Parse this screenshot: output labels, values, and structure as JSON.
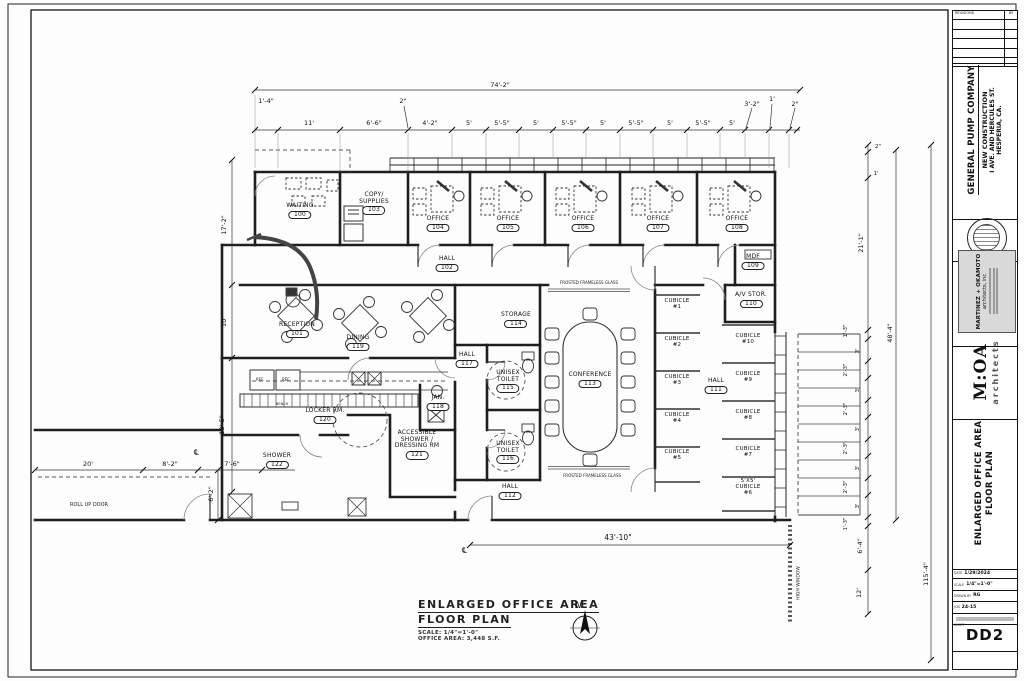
{
  "tb": {
    "client": "GENERAL PUMP COMPANY",
    "proj1": "NEW CONSTRUCTION",
    "proj2": "I AVE. AND HERCULES ST.",
    "proj3": "HESPERIA, CA.",
    "rev": "REVISIONS",
    "by": "BY",
    "firm1": "MARTINEZ + OKAMOTO",
    "firm2": "architects, inc",
    "logo": "M:OA",
    "logo_sub": "architects",
    "st1": "ENLARGED OFFICE AREA",
    "st2": "FLOOR PLAN",
    "f_date_l": "DATE",
    "f_date": "1/29/2024",
    "f_scale_l": "SCALE",
    "f_scale": "1/4\"=1'-0\"",
    "f_drawn_l": "DRAWN BY",
    "f_drawn": "RG",
    "f_job_l": "JOB",
    "f_job": "24-15",
    "sheet_l": "SHEET",
    "sheet": "DD2"
  },
  "pt": {
    "t1": "ENLARGED OFFICE AREA",
    "t2": "FLOOR PLAN",
    "scale": "SCALE: 1/4\"=1'-0\"",
    "area": "OFFICE AREA: 3,448 S.F.",
    "north": "N"
  },
  "rooms": [
    {
      "n": "WAITING",
      "id": "100"
    },
    {
      "n": "RECEPTION",
      "id": "101"
    },
    {
      "n": "HALL",
      "id": "102"
    },
    {
      "n": "COPY/\nSUPPLIES",
      "id": "103"
    },
    {
      "n": "OFFICE",
      "id": "104"
    },
    {
      "n": "OFFICE",
      "id": "105"
    },
    {
      "n": "OFFICE",
      "id": "106"
    },
    {
      "n": "OFFICE",
      "id": "107"
    },
    {
      "n": "OFFICE",
      "id": "108"
    },
    {
      "n": "MDF",
      "id": "109"
    },
    {
      "n": "A/V STOR.",
      "id": "110"
    },
    {
      "n": "HALL",
      "id": "111"
    },
    {
      "n": "HALL",
      "id": "112"
    },
    {
      "n": "CONFERENCE",
      "id": "113"
    },
    {
      "n": "STORAGE",
      "id": "114"
    },
    {
      "n": "UNISEX\nTOILET",
      "id": "115"
    },
    {
      "n": "UNISEX\nTOILET",
      "id": "116"
    },
    {
      "n": "HALL",
      "id": "117"
    },
    {
      "n": "JAN.",
      "id": "118"
    },
    {
      "n": "DINING",
      "id": "119"
    },
    {
      "n": "LOCKER RM.",
      "id": "120"
    },
    {
      "n": "ACCESSIBLE\nSHOWER /\nDRESSING RM",
      "id": "121"
    },
    {
      "n": "SHOWER",
      "id": "122"
    }
  ],
  "cubes": [
    "CUBICLE\n#1",
    "CUBICLE\n#2",
    "CUBICLE\n#3",
    "CUBICLE\n#4",
    "CUBICLE\n#5",
    "CUBICLE\n#10",
    "CUBICLE\n#9",
    "CUBICLE\n#8",
    "CUBICLE\n#7",
    "5'X5'\nCUBICLE\n#6"
  ],
  "ann": {
    "frosted": "FROSTED FRAMELESS GLASS",
    "frosted2": "FROSTED FRAMELESS GLASS",
    "rollup": "ROLL UP DOOR",
    "highwin": "HIGH WINDOW",
    "ref1": "REF.",
    "ref2": "REF.",
    "bench": "BENCH",
    "cl1": "℄",
    "cl2": "℄"
  },
  "dims": {
    "top_overall": "74'-2\"",
    "top": [
      "1'-4\"",
      "11'",
      "6'-6\"",
      "2\"",
      "4'-2\"",
      "5'",
      "5'-5\"",
      "5'",
      "5'-5\"",
      "5'",
      "5'-5\"",
      "5'",
      "5'-5\"",
      "5'",
      "3'-2\"",
      "1'",
      "2\""
    ],
    "left": [
      "17'-2\"",
      "10'",
      "18'-5\"",
      "6'-2\""
    ],
    "bl": [
      "20'",
      "8'-2\"",
      "7'-6\""
    ],
    "right": [
      "2\"",
      "1'",
      "21'-1\"",
      "1'-3\"",
      "3'",
      "2'-3\"",
      "3'",
      "2'-3\"",
      "3'",
      "2'-3\"",
      "3'",
      "2'-3\"",
      "3'",
      "1'-3\"",
      "48'-4\"",
      "6'-4\"",
      "12'",
      "115'-4\""
    ],
    "bottom": "43'-10\""
  }
}
